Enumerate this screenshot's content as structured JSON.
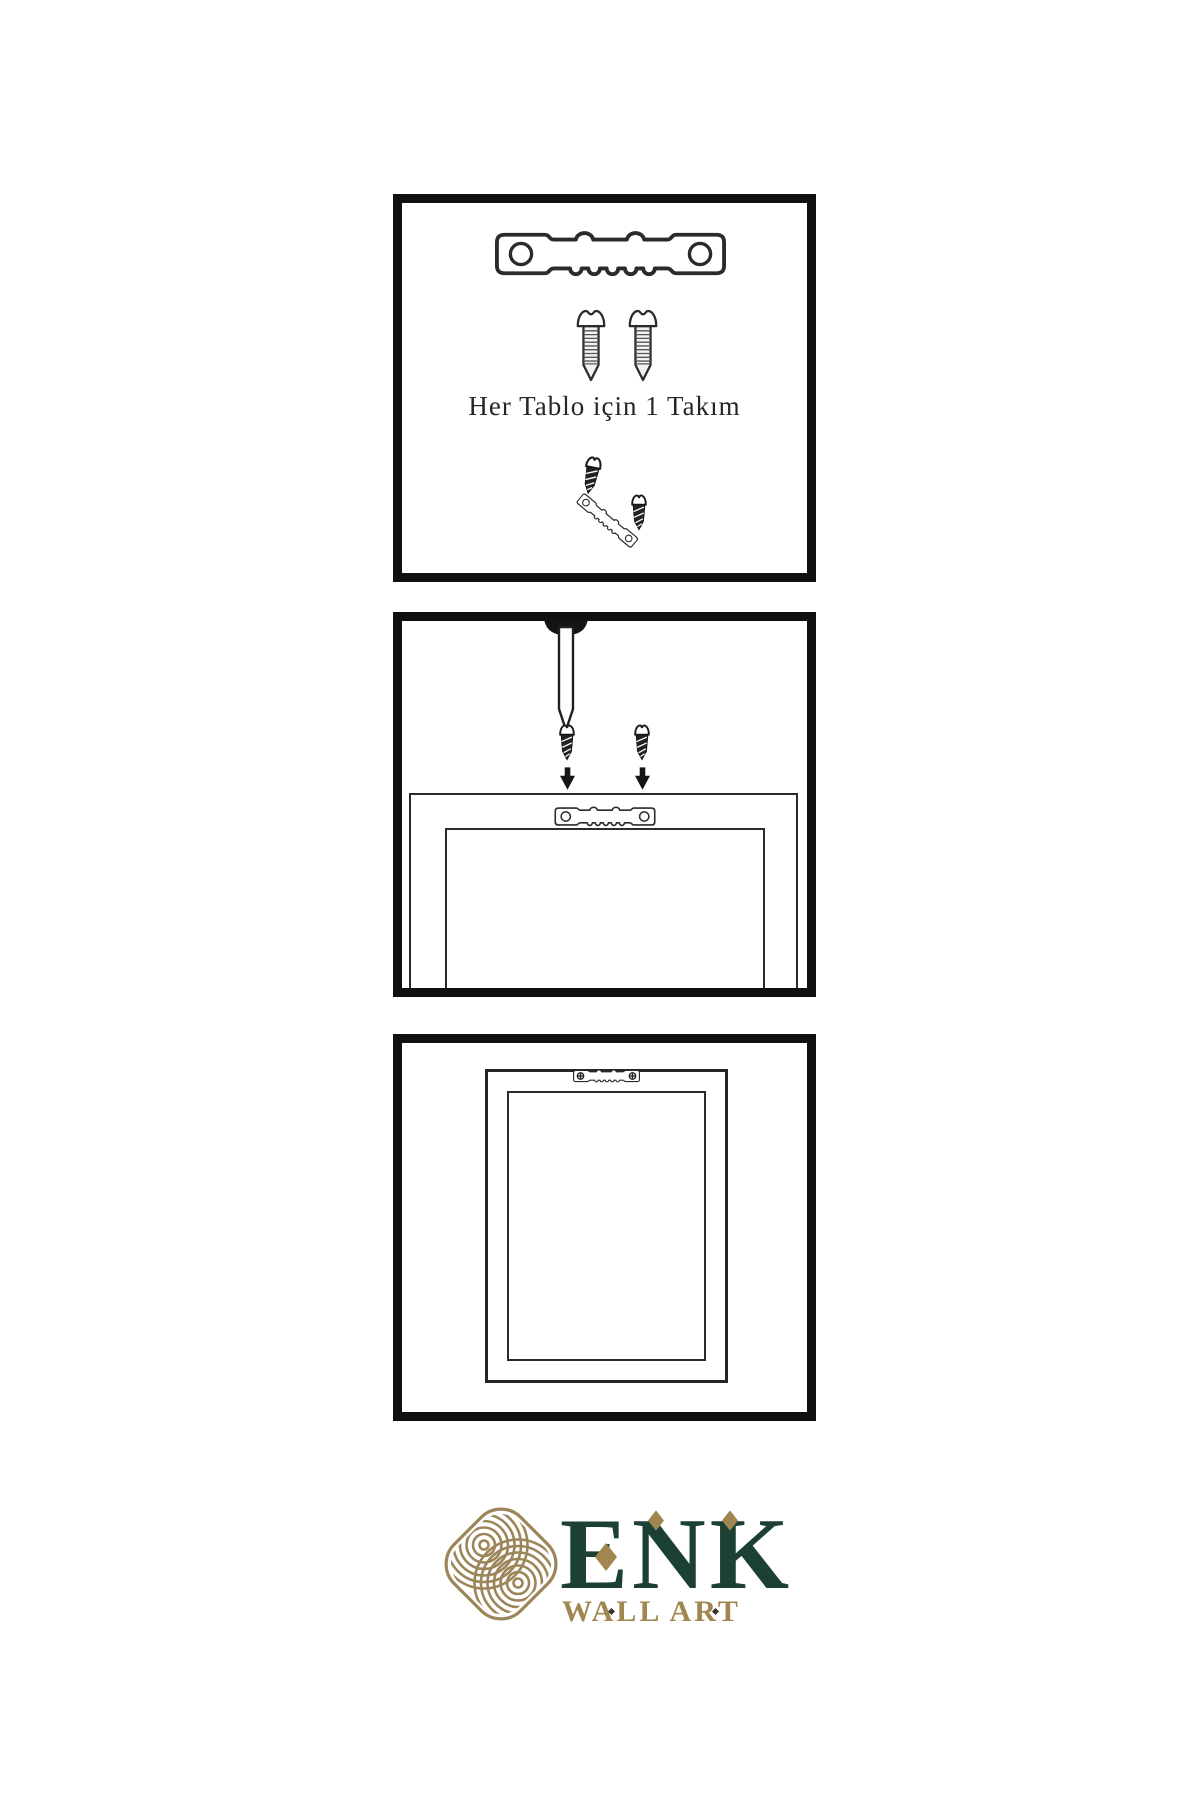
{
  "panels": {
    "kit": {
      "caption": "Her Tablo için 1 Takım",
      "hardware": [
        "sawtooth-hanger",
        "mounting-screw",
        "mounting-screw",
        "short-screw",
        "tilted-sawtooth-hanger",
        "short-screw"
      ]
    },
    "mounting": {
      "hardware": [
        "wall-nail",
        "short-screw",
        "short-screw",
        "down-arrow",
        "down-arrow",
        "sawtooth-hanger"
      ],
      "frame": "frame-back-view"
    },
    "hung": {
      "hardware": [
        "sawtooth-hanger-with-screws"
      ],
      "frame": "frame-back-view"
    }
  },
  "logo": {
    "wordmark": "ENK",
    "tagline": "WALL ART"
  },
  "colors": {
    "ink": "#1c1c1c",
    "panel_border": "#101010",
    "line": "#2b2b2b",
    "logo_green": "#1c4134",
    "logo_gold": "#a1874f",
    "knot_gold": "#9c8659",
    "caption_text": "#262626"
  }
}
